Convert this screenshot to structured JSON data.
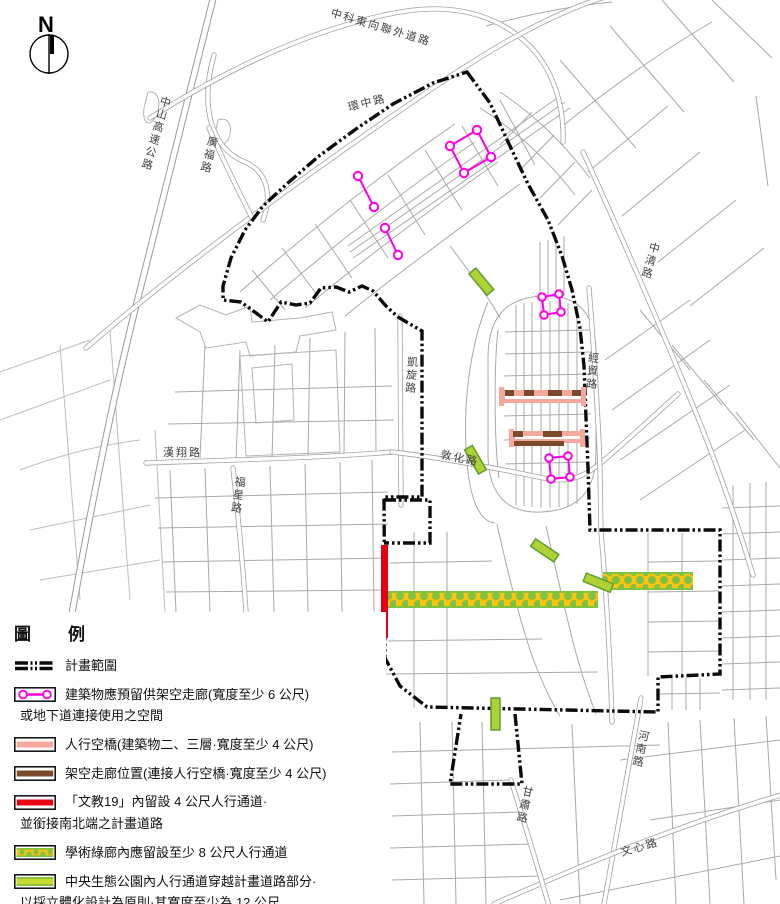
{
  "map": {
    "compass_label": "N",
    "labels": {
      "zhongke_east_rd": "中科東向聯外道路",
      "huanzhong_rd": "環中路",
      "zhongshan_fwy": "中山高速公路",
      "guangfu_rd": "廣福路",
      "zhongqing_rd": "中清路",
      "kaixuan_rd": "凱旋路",
      "jingmao_rd": "經貿路",
      "dunhua_rd": "敦化路",
      "hanxiang_rd": "漢翔路",
      "fuxing_rd": "福星路",
      "dada_rd": "達大路",
      "henan_rd": "河南路",
      "gansu_rd": "甘肅路",
      "wenxin_rd": "文心路"
    }
  },
  "legend": {
    "title": "圖　例",
    "items": [
      {
        "key": "plan-boundary",
        "label": "計畫範圍"
      },
      {
        "key": "elevated-corridor-reserve",
        "label": "建築物應預留供架空走廊(寬度至少 6 公尺)",
        "label2": "或地下道連接使用之空間"
      },
      {
        "key": "pedestrian-skybridge",
        "label": "人行空橋(建築物二、三層·寬度至少 4 公尺)"
      },
      {
        "key": "elevated-walkway-location",
        "label": "架空走廊位置(連接人行空橋·寬度至少 4 公尺)"
      },
      {
        "key": "wenjiao19-passage",
        "label": "「文教19」內留設 4 公尺人行通道·",
        "label2": "並銜接南北端之計畫道路"
      },
      {
        "key": "academic-green-corridor",
        "label": "學術綠廊內應留設至少 8 公尺人行通道"
      },
      {
        "key": "central-eco-park-passage",
        "label": "中央生態公園內人行通道穿越計畫道路部分·",
        "label2": "以採立體化設計為原則·其寬度至少為 12 公尺"
      }
    ]
  },
  "colors": {
    "boundary_black": "#0b0b0b",
    "corridor_magenta": "#ff00e6",
    "skybridge_pink": "#f5a99e",
    "walkway_brown": "#7b4a2b",
    "passage_red": "#e60012",
    "green_corridor_yellow": "#ffc20e",
    "green_corridor_dot": "#7dc242",
    "eco_passage_green": "#aed136",
    "street_gray": "#a3a3a3"
  }
}
